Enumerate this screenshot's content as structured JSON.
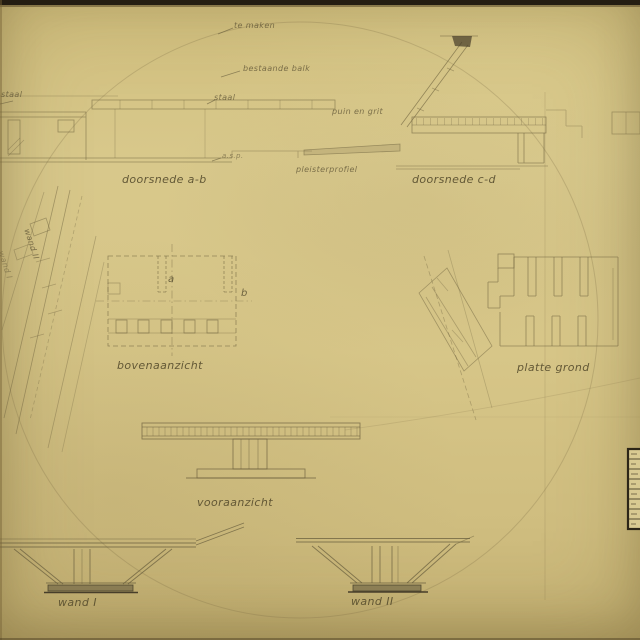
{
  "annotations": {
    "te_maken": "te maken",
    "bestaande_balk": "bestaande balk",
    "staal_top": "staal",
    "staal_left": "staal",
    "asp": "a.s.p.",
    "puin_en_grit": "puin en grit"
  },
  "labels": {
    "doorsnede_ab": "doorsnede a-b",
    "doorsnede_cd": "doorsnede c-d",
    "pleisterprofiel": "pleisterprofiel",
    "bovenaanzicht": "bovenaanzicht",
    "platte_grond": "platte grond",
    "vooraanzicht": "vooraanzicht",
    "wand_1": "wand I",
    "wand_2": "wand II",
    "wand_2_rotated": "wand II",
    "wand_1_rotated": "wand I"
  },
  "markers": {
    "a": "a",
    "b": "b"
  },
  "colors": {
    "paper": "#d6c586",
    "pencil": "#85784f",
    "edge_dark": "#241d12",
    "base_plate": "#5f5540"
  }
}
